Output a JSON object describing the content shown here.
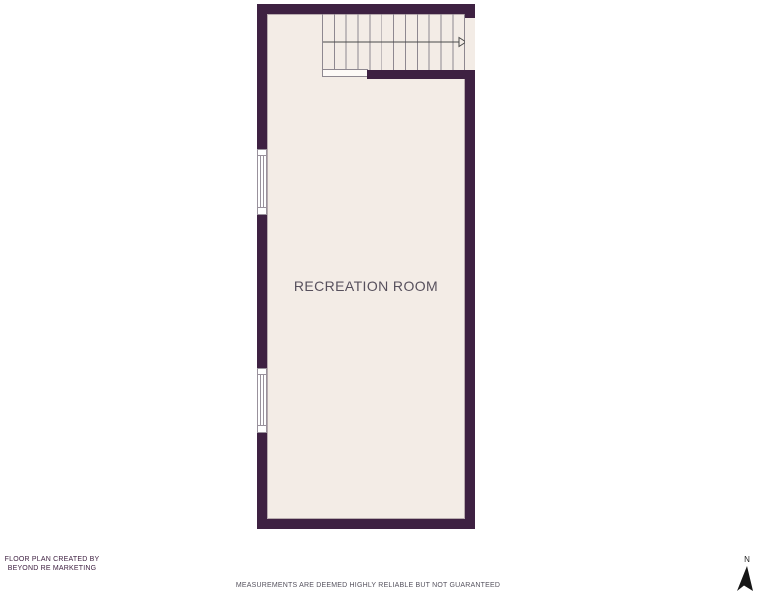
{
  "plan": {
    "room_label": "RECREATION ROOM",
    "stairs": {
      "treads": 12,
      "arrow_direction": "right"
    },
    "windows": [
      {
        "id": "window-1",
        "wall": "left"
      },
      {
        "id": "window-2",
        "wall": "left"
      }
    ]
  },
  "footer": {
    "credit_line1": "FLOOR PLAN CREATED BY",
    "credit_line2": "BEYOND RE MARKETING",
    "disclaimer": "MEASUREMENTS ARE DEEMED HIGHLY RELIABLE BUT NOT GUARANTEED"
  },
  "compass": {
    "north_label": "N"
  },
  "colors": {
    "wall": "#3e2142",
    "floor": "#f3ece6",
    "background": "#ffffff",
    "stair_line": "#8e8890",
    "room_label_text": "#57505d",
    "credit_text": "#3f2142",
    "disclaimer_text": "#55525e"
  }
}
